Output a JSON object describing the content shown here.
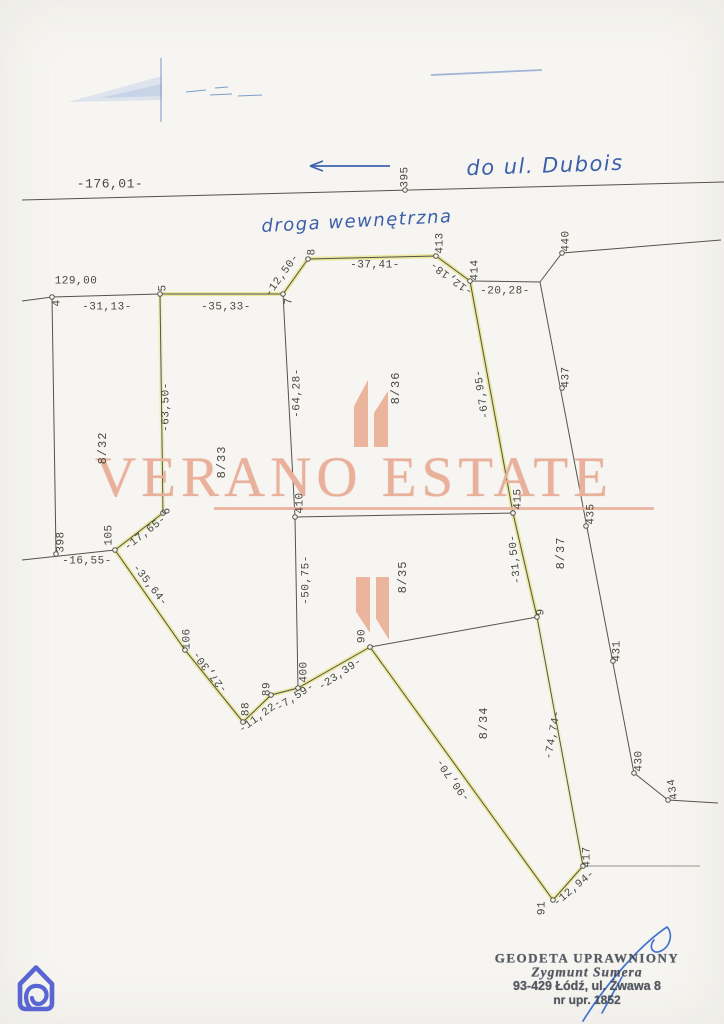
{
  "watermark": {
    "text": "VERANO ESTATE",
    "color": "#e9b19b"
  },
  "handwriting": {
    "to_street": "do ul. Dubois",
    "road_note": "droga wewnętrzna"
  },
  "measurements": {
    "m176_01": "-176,01-",
    "m129_00": "129,00",
    "m31_13": "-31,13-",
    "m35_33": "-35,33-",
    "m12_50": "-12,50-",
    "m37_41": "-37,41-",
    "m12_18": "-12,18-",
    "m20_28": "-20,28-",
    "m63_50": "-63,50-",
    "m64_28": "-64,28-",
    "m67_95": "-67,95-",
    "m17_65": "-17,65-",
    "m16_55": "-16,55-",
    "m35_64": "-35,64-",
    "m50_75": "-50,75-",
    "m31_50": "-31,50-",
    "m27_30": "-27,30-",
    "m11_22": "-11,22-",
    "m7_59": "-7,59-",
    "m23_39": "-23,39-",
    "m74_74": "-74,74-",
    "m90_70": "-90,70-",
    "m12_94": "-12,94-"
  },
  "points": {
    "n4": "4",
    "n5": "5",
    "n6": "6",
    "n7": "7",
    "n8": "8",
    "n9": "9",
    "n88": "88",
    "n89": "89",
    "n90": "90",
    "n91": "91",
    "n105": "105",
    "n106": "106",
    "n395": "395",
    "n398": "398",
    "n400": "400",
    "n410": "410",
    "n413": "413",
    "n414": "414",
    "n415": "415",
    "n417": "417",
    "n430": "430",
    "n431": "431",
    "n434": "434",
    "n435": "435",
    "n437": "437",
    "n440": "440"
  },
  "parcels": {
    "p8_32": "8/32",
    "p8_33": "8/33",
    "p8_34": "8/34",
    "p8_35": "8/35",
    "p8_36": "8/36",
    "p8_37": "8/37"
  },
  "stamp": {
    "line1": "GEODETA UPRAWNIONY",
    "line2": "Zygmunt Sumera",
    "line3": "93-429 Łódź, ul. Żwawa 8",
    "line4": "nr upr. 1852"
  },
  "colors": {
    "highlight_yellow": "#e9e794",
    "boundary_line": "#55534c",
    "ink_blue": "#3e63ad",
    "watermark_peach": "#e9b19b",
    "logo_indigo": "#5865d2",
    "stamp_ink": "#3d424d",
    "signature_blue": "#2f68c9"
  }
}
